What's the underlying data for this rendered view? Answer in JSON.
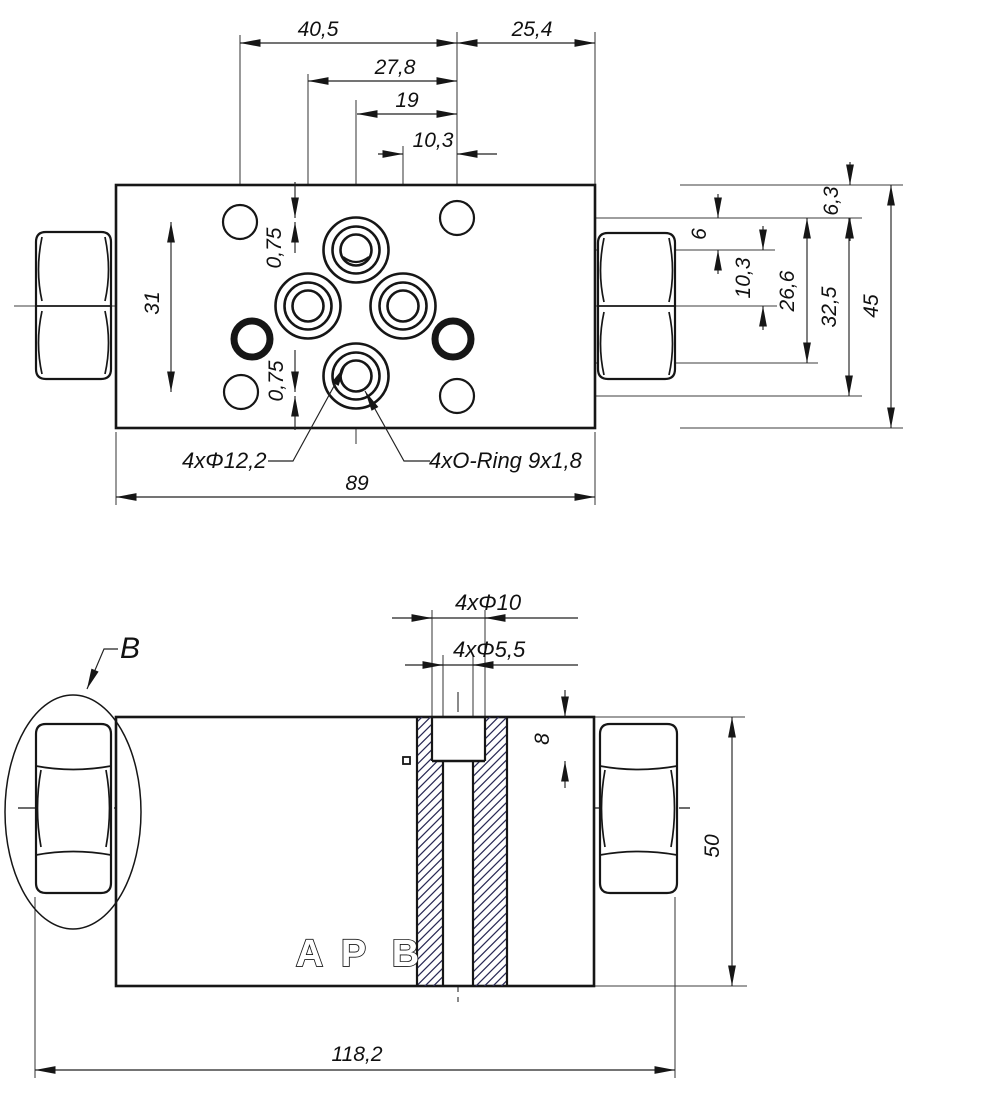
{
  "drawing_type": "valve-plate-technical-drawing",
  "colors": {
    "background": "#ffffff",
    "line": "#161616",
    "thin_line": "#2f2f2f",
    "hatch": "#2a2a55"
  },
  "labels": {
    "dim_40_5": "40,5",
    "dim_25_4": "25,4",
    "dim_27_8": "27,8",
    "dim_19": "19",
    "dim_10_3_top": "10,3",
    "dim_0_75_upper": "0,75",
    "dim_0_75_lower": "0,75",
    "dim_31": "31",
    "dim_6_3": "6,3",
    "dim_6": "6",
    "dim_10_3_right": "10,3",
    "dim_26_6": "26,6",
    "dim_32_5": "32,5",
    "dim_45": "45",
    "dim_89": "89",
    "label_holes": "4xΦ12,2",
    "label_oring": "4xO-Ring 9x1,8",
    "detail_b": "B",
    "dim_4xd10": "4xΦ10",
    "dim_4xd5_5": "4xΦ5,5",
    "dim_8": "8",
    "dim_50": "50",
    "dim_118_2": "118,2",
    "port_a": "A",
    "port_p": "P",
    "port_b": "B"
  }
}
